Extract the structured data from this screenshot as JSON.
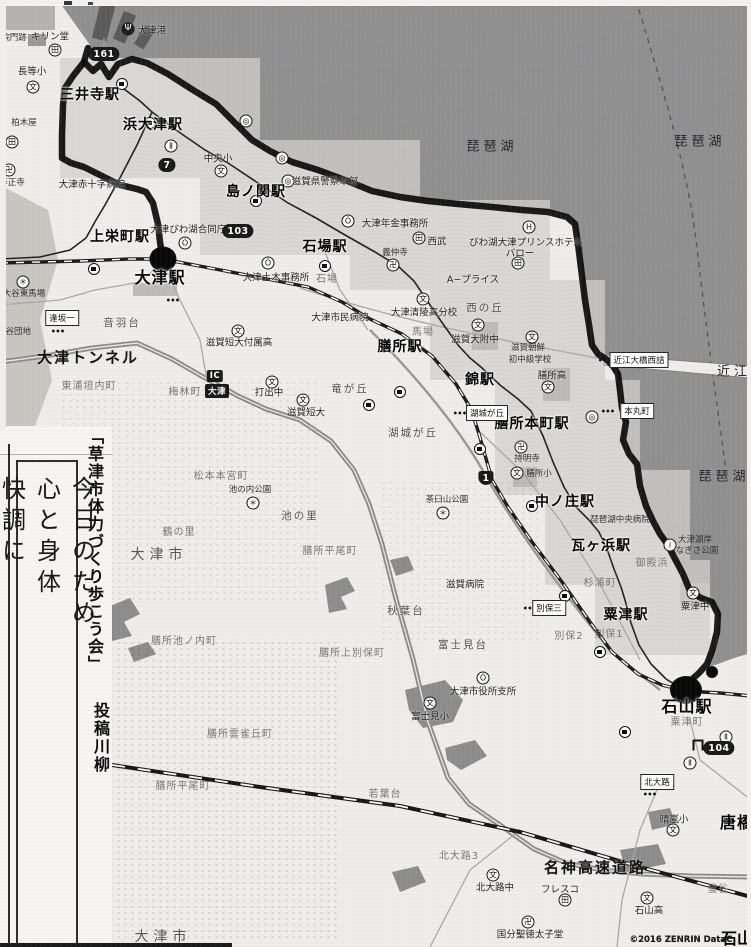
{
  "sidebar": {
    "header": "「草津市体力づくり歩こう会」",
    "subheader": "投稿川柳",
    "poem": {
      "lines": [
        "今日のため",
        "心と身体",
        "快調に"
      ]
    }
  },
  "footer": {
    "copyright": "©2016 ZENRIN DataC",
    "corner_label": "石山"
  },
  "map": {
    "stations": [
      {
        "t": "三井寺駅",
        "x": 90,
        "y": 95,
        "c": "sta"
      },
      {
        "t": "浜大津駅",
        "x": 153,
        "y": 125,
        "c": "sta"
      },
      {
        "t": "島ノ関駅",
        "x": 256,
        "y": 192,
        "c": "sta"
      },
      {
        "t": "石場駅",
        "x": 325,
        "y": 247,
        "c": "sta"
      },
      {
        "t": "上栄町駅",
        "x": 120,
        "y": 237,
        "c": "sta"
      },
      {
        "t": "大津駅",
        "x": 160,
        "y": 278,
        "c": "sta-lg"
      },
      {
        "t": "膳所駅",
        "x": 400,
        "y": 347,
        "c": "sta"
      },
      {
        "t": "錦駅",
        "x": 480,
        "y": 380,
        "c": "sta"
      },
      {
        "t": "膳所本町駅",
        "x": 532,
        "y": 424,
        "c": "sta"
      },
      {
        "t": "中ノ庄駅",
        "x": 565,
        "y": 502,
        "c": "sta"
      },
      {
        "t": "瓦ヶ浜駅",
        "x": 601,
        "y": 546,
        "c": "sta"
      },
      {
        "t": "粟津駅",
        "x": 626,
        "y": 615,
        "c": "sta"
      },
      {
        "t": "石山駅",
        "x": 687,
        "y": 707,
        "c": "sta-lg"
      },
      {
        "t": "唐橋",
        "x": 737,
        "y": 823,
        "c": "sta-lg"
      }
    ],
    "lake_labels": [
      {
        "t": "琵琶湖",
        "x": 492,
        "y": 147,
        "c": "lake"
      },
      {
        "t": "琵琶湖",
        "x": 700,
        "y": 142,
        "c": "lake"
      },
      {
        "t": "琵琶湖",
        "x": 724,
        "y": 477,
        "c": "lake"
      },
      {
        "t": "近江",
        "x": 734,
        "y": 372,
        "c": "lake"
      }
    ],
    "labels": [
      {
        "t": "院門跡",
        "x": 14,
        "y": 38,
        "c": "tiny"
      },
      {
        "t": "キリン堂",
        "x": 50,
        "y": 37,
        "c": "fac"
      },
      {
        "t": "大津港",
        "x": 152,
        "y": 31,
        "c": "fac"
      },
      {
        "t": "長等小",
        "x": 32,
        "y": 72,
        "c": "fac"
      },
      {
        "t": "柏木屋",
        "x": 24,
        "y": 123,
        "c": "tiny"
      },
      {
        "t": "等正寺",
        "x": 12,
        "y": 183,
        "c": "tiny"
      },
      {
        "t": "中央小",
        "x": 218,
        "y": 159,
        "c": "fac"
      },
      {
        "t": "大津赤十字病院",
        "x": 92,
        "y": 185,
        "c": "fac"
      },
      {
        "t": "大津びわ湖合同庁舎",
        "x": 193,
        "y": 230,
        "c": "fac"
      },
      {
        "t": "滋賀県警察本部",
        "x": 325,
        "y": 182,
        "c": "fac"
      },
      {
        "t": "大津年金事務所",
        "x": 395,
        "y": 224,
        "c": "fac"
      },
      {
        "t": "西武",
        "x": 437,
        "y": 242,
        "c": "fac"
      },
      {
        "t": "義仲寺",
        "x": 395,
        "y": 253,
        "c": "tiny"
      },
      {
        "t": "A−プライス",
        "x": 473,
        "y": 280,
        "c": "fac"
      },
      {
        "t": "びわ湖大津プリンスホテル",
        "x": 526,
        "y": 243,
        "c": "fac"
      },
      {
        "t": "バロー",
        "x": 520,
        "y": 254,
        "c": "fac"
      },
      {
        "t": "大津土木事務所",
        "x": 276,
        "y": 278,
        "c": "fac"
      },
      {
        "t": "石場",
        "x": 327,
        "y": 280,
        "c": "areaf"
      },
      {
        "t": "大津市民病院",
        "x": 340,
        "y": 318,
        "c": "fac"
      },
      {
        "t": "大津清陵高分校",
        "x": 424,
        "y": 313,
        "c": "fac"
      },
      {
        "t": "西の丘",
        "x": 485,
        "y": 308,
        "c": "area"
      },
      {
        "t": "滋賀大附中",
        "x": 475,
        "y": 340,
        "c": "fac"
      },
      {
        "t": "滋賀朝鮮",
        "x": 528,
        "y": 348,
        "c": "tiny"
      },
      {
        "t": "初中級学校",
        "x": 530,
        "y": 360,
        "c": "tiny"
      },
      {
        "t": "膳所高",
        "x": 552,
        "y": 376,
        "c": "fac"
      },
      {
        "t": "馬場",
        "x": 423,
        "y": 333,
        "c": "areaf"
      },
      {
        "t": "竜が丘",
        "x": 350,
        "y": 389,
        "c": "area"
      },
      {
        "t": "湖城が丘",
        "x": 413,
        "y": 433,
        "c": "area"
      },
      {
        "t": "滋賀短大付属高",
        "x": 239,
        "y": 343,
        "c": "fac"
      },
      {
        "t": "打出中",
        "x": 269,
        "y": 393,
        "c": "fac"
      },
      {
        "t": "滋賀短大",
        "x": 306,
        "y": 413,
        "c": "fac"
      },
      {
        "t": "音羽台",
        "x": 122,
        "y": 323,
        "c": "area"
      },
      {
        "t": "大谷東馬場",
        "x": 24,
        "y": 294,
        "c": "tiny"
      },
      {
        "t": "大谷団地",
        "x": 14,
        "y": 332,
        "c": "tiny"
      },
      {
        "t": "大津トンネル",
        "x": 88,
        "y": 358,
        "c": "road"
      },
      {
        "t": "東浦垣内町",
        "x": 89,
        "y": 387,
        "c": "areaf"
      },
      {
        "t": "梅林町",
        "x": 185,
        "y": 393,
        "c": "areaf"
      },
      {
        "t": "松本本宮町",
        "x": 221,
        "y": 477,
        "c": "areaf"
      },
      {
        "t": "池の内公園",
        "x": 250,
        "y": 490,
        "c": "tiny"
      },
      {
        "t": "池の里",
        "x": 300,
        "y": 516,
        "c": "area"
      },
      {
        "t": "鶴の里",
        "x": 179,
        "y": 533,
        "c": "areaf"
      },
      {
        "t": "膳所平尾町",
        "x": 330,
        "y": 552,
        "c": "areaf"
      },
      {
        "t": "茶臼山公園",
        "x": 447,
        "y": 500,
        "c": "tiny"
      },
      {
        "t": "持明寺",
        "x": 527,
        "y": 459,
        "c": "tiny"
      },
      {
        "t": "膳所小",
        "x": 539,
        "y": 474,
        "c": "tiny"
      },
      {
        "t": "琵琶湖中央病院",
        "x": 620,
        "y": 520,
        "c": "tiny"
      },
      {
        "t": "大津湖岸",
        "x": 695,
        "y": 540,
        "c": "tiny"
      },
      {
        "t": "なぎさ公園",
        "x": 697,
        "y": 551,
        "c": "tiny"
      },
      {
        "t": "御殿浜",
        "x": 652,
        "y": 564,
        "c": "areaf"
      },
      {
        "t": "杉浦町",
        "x": 600,
        "y": 584,
        "c": "areaf"
      },
      {
        "t": "粟津中",
        "x": 695,
        "y": 607,
        "c": "fac"
      },
      {
        "t": "別保2",
        "x": 569,
        "y": 637,
        "c": "areaf"
      },
      {
        "t": "別保1",
        "x": 609,
        "y": 635,
        "c": "areaf"
      },
      {
        "t": "滋賀病院",
        "x": 465,
        "y": 585,
        "c": "fac"
      },
      {
        "t": "秋葉台",
        "x": 406,
        "y": 611,
        "c": "area"
      },
      {
        "t": "富士見台",
        "x": 463,
        "y": 645,
        "c": "area"
      },
      {
        "t": "膳所上別保町",
        "x": 352,
        "y": 654,
        "c": "areaf"
      },
      {
        "t": "大津市役所支所",
        "x": 483,
        "y": 692,
        "c": "fac"
      },
      {
        "t": "富士見小",
        "x": 430,
        "y": 717,
        "c": "fac"
      },
      {
        "t": "膳所池ノ内町",
        "x": 184,
        "y": 642,
        "c": "areaf"
      },
      {
        "t": "膳所雲雀丘町",
        "x": 240,
        "y": 735,
        "c": "areaf"
      },
      {
        "t": "膳所平尾町",
        "x": 183,
        "y": 787,
        "c": "areaf"
      },
      {
        "t": "若葉台",
        "x": 385,
        "y": 795,
        "c": "areaf"
      },
      {
        "t": "粟津町",
        "x": 687,
        "y": 723,
        "c": "areaf"
      },
      {
        "t": "北大路3",
        "x": 459,
        "y": 857,
        "c": "areaf"
      },
      {
        "t": "北大路中",
        "x": 495,
        "y": 888,
        "c": "fac"
      },
      {
        "t": "フレスコ",
        "x": 560,
        "y": 890,
        "c": "fac"
      },
      {
        "t": "国分聖徳太子堂",
        "x": 530,
        "y": 935,
        "c": "fac"
      },
      {
        "t": "石山高",
        "x": 649,
        "y": 911,
        "c": "fac"
      },
      {
        "t": "晴嵐小",
        "x": 674,
        "y": 820,
        "c": "fac"
      },
      {
        "t": "螢谷",
        "x": 718,
        "y": 890,
        "c": "areaf"
      },
      {
        "t": "名神高速道路",
        "x": 595,
        "y": 868,
        "c": "road"
      },
      {
        "t": "大津市",
        "x": 159,
        "y": 555,
        "c": "city"
      },
      {
        "t": "大津市",
        "x": 163,
        "y": 937,
        "c": "city"
      },
      {
        "t": "逢坂",
        "x": 36,
        "y": 450,
        "c": "tiny"
      },
      {
        "t": "駅",
        "x": 26,
        "y": 439,
        "c": "fac"
      },
      {
        "t": "■",
        "x": 84,
        "y": 753,
        "c": "mark"
      },
      {
        "t": "♣",
        "x": 46,
        "y": 938,
        "c": "flower"
      },
      {
        "t": "©2016 ZENRIN DataC",
        "x": 681,
        "y": 940,
        "c": "copy"
      },
      {
        "t": "石山",
        "x": 737,
        "y": 939,
        "c": "corner"
      }
    ],
    "badges": [
      {
        "t": "161",
        "x": 104,
        "y": 54,
        "c": ""
      },
      {
        "t": "7",
        "x": 167,
        "y": 165,
        "c": ""
      },
      {
        "t": "103",
        "x": 238,
        "y": 231,
        "c": ""
      },
      {
        "t": "1",
        "x": 486,
        "y": 478,
        "c": "tri"
      },
      {
        "t": "104",
        "x": 719,
        "y": 748,
        "c": ""
      },
      {
        "t": "IC",
        "x": 215,
        "y": 376,
        "c": "sq"
      },
      {
        "t": "大津",
        "x": 217,
        "y": 391,
        "c": "sq"
      }
    ],
    "boxed_labels": [
      {
        "t": "湖城が丘",
        "x": 487,
        "y": 413
      },
      {
        "t": "近江大橋西詰",
        "x": 639,
        "y": 360
      },
      {
        "t": "本丸町",
        "x": 637,
        "y": 411
      },
      {
        "t": "別保三",
        "x": 549,
        "y": 608
      },
      {
        "t": "逢坂一",
        "x": 62,
        "y": 318
      },
      {
        "t": "北大路",
        "x": 657,
        "y": 782
      }
    ],
    "icons": [
      {
        "g": "文",
        "x": 33,
        "y": 87,
        "c": "ic",
        "n": "school-icon"
      },
      {
        "g": "文",
        "x": 221,
        "y": 171,
        "c": "ic",
        "n": "school-icon"
      },
      {
        "g": "文",
        "x": 423,
        "y": 299,
        "c": "ic",
        "n": "school-icon"
      },
      {
        "g": "文",
        "x": 478,
        "y": 325,
        "c": "ic",
        "n": "school-icon"
      },
      {
        "g": "文",
        "x": 532,
        "y": 337,
        "c": "ic",
        "n": "school-icon"
      },
      {
        "g": "文",
        "x": 548,
        "y": 387,
        "c": "ic",
        "n": "school-icon"
      },
      {
        "g": "文",
        "x": 517,
        "y": 473,
        "c": "ic",
        "n": "school-icon"
      },
      {
        "g": "文",
        "x": 238,
        "y": 331,
        "c": "ic",
        "n": "school-icon"
      },
      {
        "g": "文",
        "x": 272,
        "y": 382,
        "c": "ic",
        "n": "school-icon"
      },
      {
        "g": "文",
        "x": 303,
        "y": 400,
        "c": "ic",
        "n": "school-icon"
      },
      {
        "g": "文",
        "x": 430,
        "y": 703,
        "c": "ic",
        "n": "school-icon"
      },
      {
        "g": "文",
        "x": 493,
        "y": 875,
        "c": "ic",
        "n": "school-icon"
      },
      {
        "g": "文",
        "x": 647,
        "y": 898,
        "c": "ic",
        "n": "school-icon"
      },
      {
        "g": "文",
        "x": 673,
        "y": 830,
        "c": "ic",
        "n": "school-icon"
      },
      {
        "g": "文",
        "x": 693,
        "y": 593,
        "c": "ic",
        "n": "school-icon"
      },
      {
        "g": "卍",
        "x": 9,
        "y": 170,
        "c": "ic",
        "n": "temple-icon"
      },
      {
        "g": "卍",
        "x": 393,
        "y": 265,
        "c": "ic",
        "n": "temple-icon"
      },
      {
        "g": "卍",
        "x": 521,
        "y": 447,
        "c": "ic",
        "n": "temple-icon"
      },
      {
        "g": "卍",
        "x": 528,
        "y": 922,
        "c": "ic",
        "n": "temple-icon"
      },
      {
        "g": "田",
        "x": 55,
        "y": 50,
        "c": "ic",
        "n": "store-icon"
      },
      {
        "g": "田",
        "x": 12,
        "y": 142,
        "c": "ic",
        "n": "store-icon"
      },
      {
        "g": "田",
        "x": 419,
        "y": 238,
        "c": "ic",
        "n": "store-icon"
      },
      {
        "g": "田",
        "x": 518,
        "y": 263,
        "c": "ic",
        "n": "store-icon"
      },
      {
        "g": "田",
        "x": 565,
        "y": 900,
        "c": "ic",
        "n": "store-icon"
      },
      {
        "g": "Ó",
        "x": 185,
        "y": 243,
        "c": "ic",
        "n": "gov-office-icon"
      },
      {
        "g": "Ó",
        "x": 348,
        "y": 221,
        "c": "ic",
        "n": "gov-office-icon"
      },
      {
        "g": "Ó",
        "x": 268,
        "y": 263,
        "c": "ic",
        "n": "gov-office-icon"
      },
      {
        "g": "Ó",
        "x": 483,
        "y": 678,
        "c": "ic",
        "n": "gov-office-icon"
      },
      {
        "g": "◎",
        "x": 288,
        "y": 181,
        "c": "ic",
        "n": "police-hq-icon"
      },
      {
        "g": "◎",
        "x": 592,
        "y": 417,
        "c": "ic",
        "n": "poi-icon"
      },
      {
        "g": "◎",
        "x": 246,
        "y": 121,
        "c": "ic",
        "n": "poi-icon"
      },
      {
        "g": "◎",
        "x": 282,
        "y": 158,
        "c": "ic",
        "n": "poi-icon"
      },
      {
        "g": "H",
        "x": 529,
        "y": 227,
        "c": "ic",
        "n": "hotel-icon"
      },
      {
        "g": "i",
        "x": 670,
        "y": 545,
        "c": "ic",
        "n": "info-icon"
      },
      {
        "g": "Ⅱ",
        "x": 171,
        "y": 146,
        "c": "ic",
        "n": "poi-icon"
      },
      {
        "g": "Ⅱ",
        "x": 726,
        "y": 737,
        "c": "ic",
        "n": "poi-icon"
      },
      {
        "g": "Ⅱ",
        "x": 690,
        "y": 763,
        "c": "ic",
        "n": "poi-icon"
      },
      {
        "g": "＊",
        "x": 443,
        "y": 513,
        "c": "ic",
        "n": "park-icon"
      },
      {
        "g": "＊",
        "x": 253,
        "y": 503,
        "c": "ic",
        "n": "park-icon"
      },
      {
        "g": "Ψ",
        "x": 128,
        "y": 29,
        "c": "ic dk",
        "n": "port-anchor-icon"
      },
      {
        "g": "＊",
        "x": 23,
        "y": 282,
        "c": "ic",
        "n": "poi-icon"
      }
    ],
    "station_markers": [
      {
        "x": 122,
        "y": 84
      },
      {
        "x": 150,
        "y": 111
      },
      {
        "x": 256,
        "y": 177
      },
      {
        "x": 325,
        "y": 230
      },
      {
        "x": 94,
        "y": 221
      },
      {
        "x": 400,
        "y": 332
      },
      {
        "x": 369,
        "y": 333
      },
      {
        "x": 480,
        "y": 365
      },
      {
        "x": 532,
        "y": 410
      },
      {
        "x": 565,
        "y": 488
      },
      {
        "x": 600,
        "y": 532
      },
      {
        "x": 625,
        "y": 600
      }
    ],
    "route_nodes": [
      {
        "x": 163,
        "y": 259,
        "c": "blob-lg",
        "n": "course-start-otsu-station"
      },
      {
        "x": 686,
        "y": 690,
        "c": "blob-xl",
        "n": "course-end-ishiyama-station"
      },
      {
        "x": 712,
        "y": 672,
        "c": "blob-sm",
        "n": "course-node"
      }
    ],
    "bus_stops": [
      {
        "x": 605,
        "y": 360
      },
      {
        "x": 608,
        "y": 411
      },
      {
        "x": 530,
        "y": 608
      },
      {
        "x": 58,
        "y": 331
      },
      {
        "x": 650,
        "y": 794
      },
      {
        "x": 460,
        "y": 413
      },
      {
        "x": 173,
        "y": 300
      }
    ],
    "shrines": [
      {
        "x": 698,
        "y": 745
      }
    ]
  }
}
